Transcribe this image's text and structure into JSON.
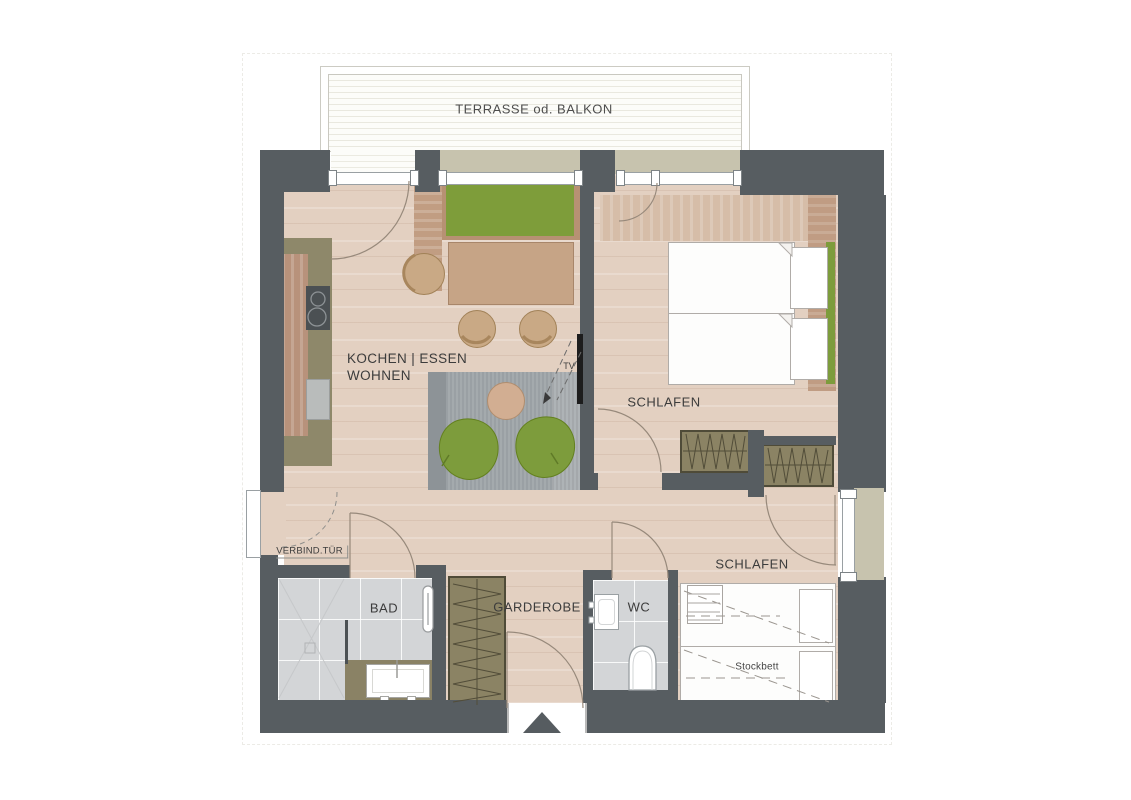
{
  "plan": {
    "labels": {
      "terrace": "TERRASSE od. BALKON",
      "kitchen_dining": "KOCHEN | ESSEN",
      "living": "WOHNEN",
      "bedroom1": "SCHLAFEN",
      "bedroom2": "SCHLAFEN",
      "bath": "BAD",
      "wardrobe_room": "GARDEROBE",
      "wc": "WC",
      "tv": "TV",
      "connecting_door": "VERBIND.TÜR",
      "bunk_bed": "Stockbett"
    },
    "colors": {
      "wall": "#575d61",
      "wood_floor": "#e3d0c1",
      "tile": "#d3d5d7",
      "accent_green": "#7d9c3c",
      "cabinet_olive": "#8b8364",
      "counter_olive": "#8e886a",
      "wood_furniture": "#c6a486",
      "rug_gray": "#9aa0a4",
      "exterior_khaki": "#c7c3ae",
      "tv_black": "#1d1d1d"
    }
  }
}
